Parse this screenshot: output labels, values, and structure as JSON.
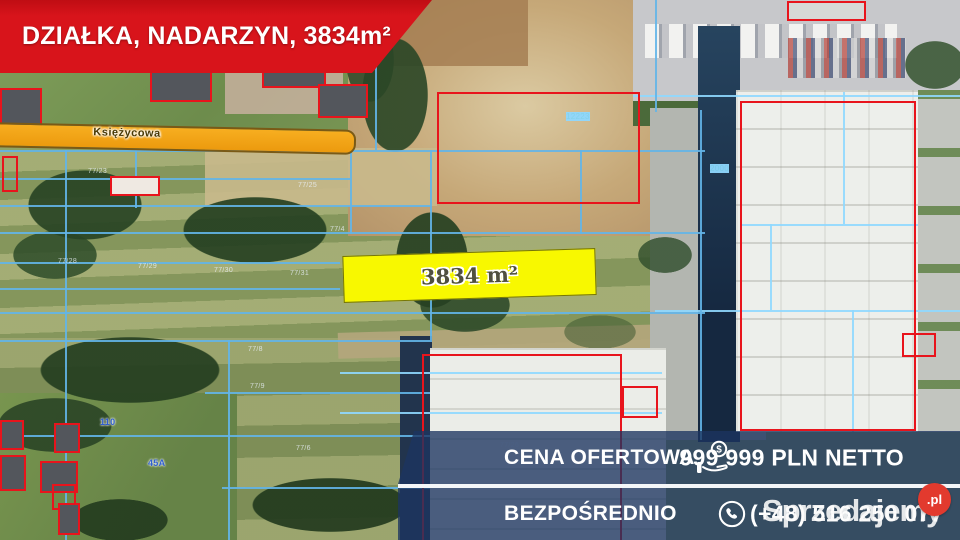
{
  "banner": {
    "title": "DZIAŁKA, NADARZYN, 3834m²"
  },
  "map": {
    "road_label": "Księżycowa",
    "highlight_area_label": "3834 m²",
    "parcel_labels": [
      {
        "text": "110",
        "x": 100,
        "y": 417,
        "cls": "blue"
      },
      {
        "text": "45A",
        "x": 148,
        "y": 458,
        "cls": "blue"
      },
      {
        "text": "12223",
        "x": 566,
        "y": 112,
        "cls": "cyan"
      },
      {
        "text": "2000",
        "x": 710,
        "y": 164,
        "cls": "cyan"
      },
      {
        "text": "77/23",
        "x": 88,
        "y": 168,
        "cls": ""
      },
      {
        "text": "77/25",
        "x": 298,
        "y": 182,
        "cls": ""
      },
      {
        "text": "77/4",
        "x": 330,
        "y": 226,
        "cls": ""
      },
      {
        "text": "77/28",
        "x": 58,
        "y": 258,
        "cls": ""
      },
      {
        "text": "77/29",
        "x": 138,
        "y": 263,
        "cls": ""
      },
      {
        "text": "77/30",
        "x": 214,
        "y": 267,
        "cls": ""
      },
      {
        "text": "77/31",
        "x": 290,
        "y": 270,
        "cls": ""
      },
      {
        "text": "77/8",
        "x": 248,
        "y": 346,
        "cls": ""
      },
      {
        "text": "77/9",
        "x": 250,
        "y": 383,
        "cls": ""
      },
      {
        "text": "77/26",
        "x": 500,
        "y": 442,
        "cls": ""
      },
      {
        "text": "77/6",
        "x": 296,
        "y": 445,
        "cls": ""
      }
    ]
  },
  "info_panel": {
    "rows": [
      {
        "label": "CENA OFERTOWA",
        "value": "999 999 PLN NETTO",
        "icon": "money-hand-icon"
      },
      {
        "label": "BEZPOŚREDNIO",
        "value": "(+48) 516 250 077",
        "icon": "phone-icon"
      }
    ]
  },
  "watermark": {
    "brand": "Sprzedajemy",
    "suffix": ".pl"
  },
  "colors": {
    "banner_red": "#d8141b",
    "overlay_navy": "rgba(28,53,96,0.78)",
    "highlight_yellow": "#f8f800",
    "road_orange": "#f2a51c",
    "cadastral_blue": "#63b5e8",
    "outline_red": "#e8141c"
  }
}
